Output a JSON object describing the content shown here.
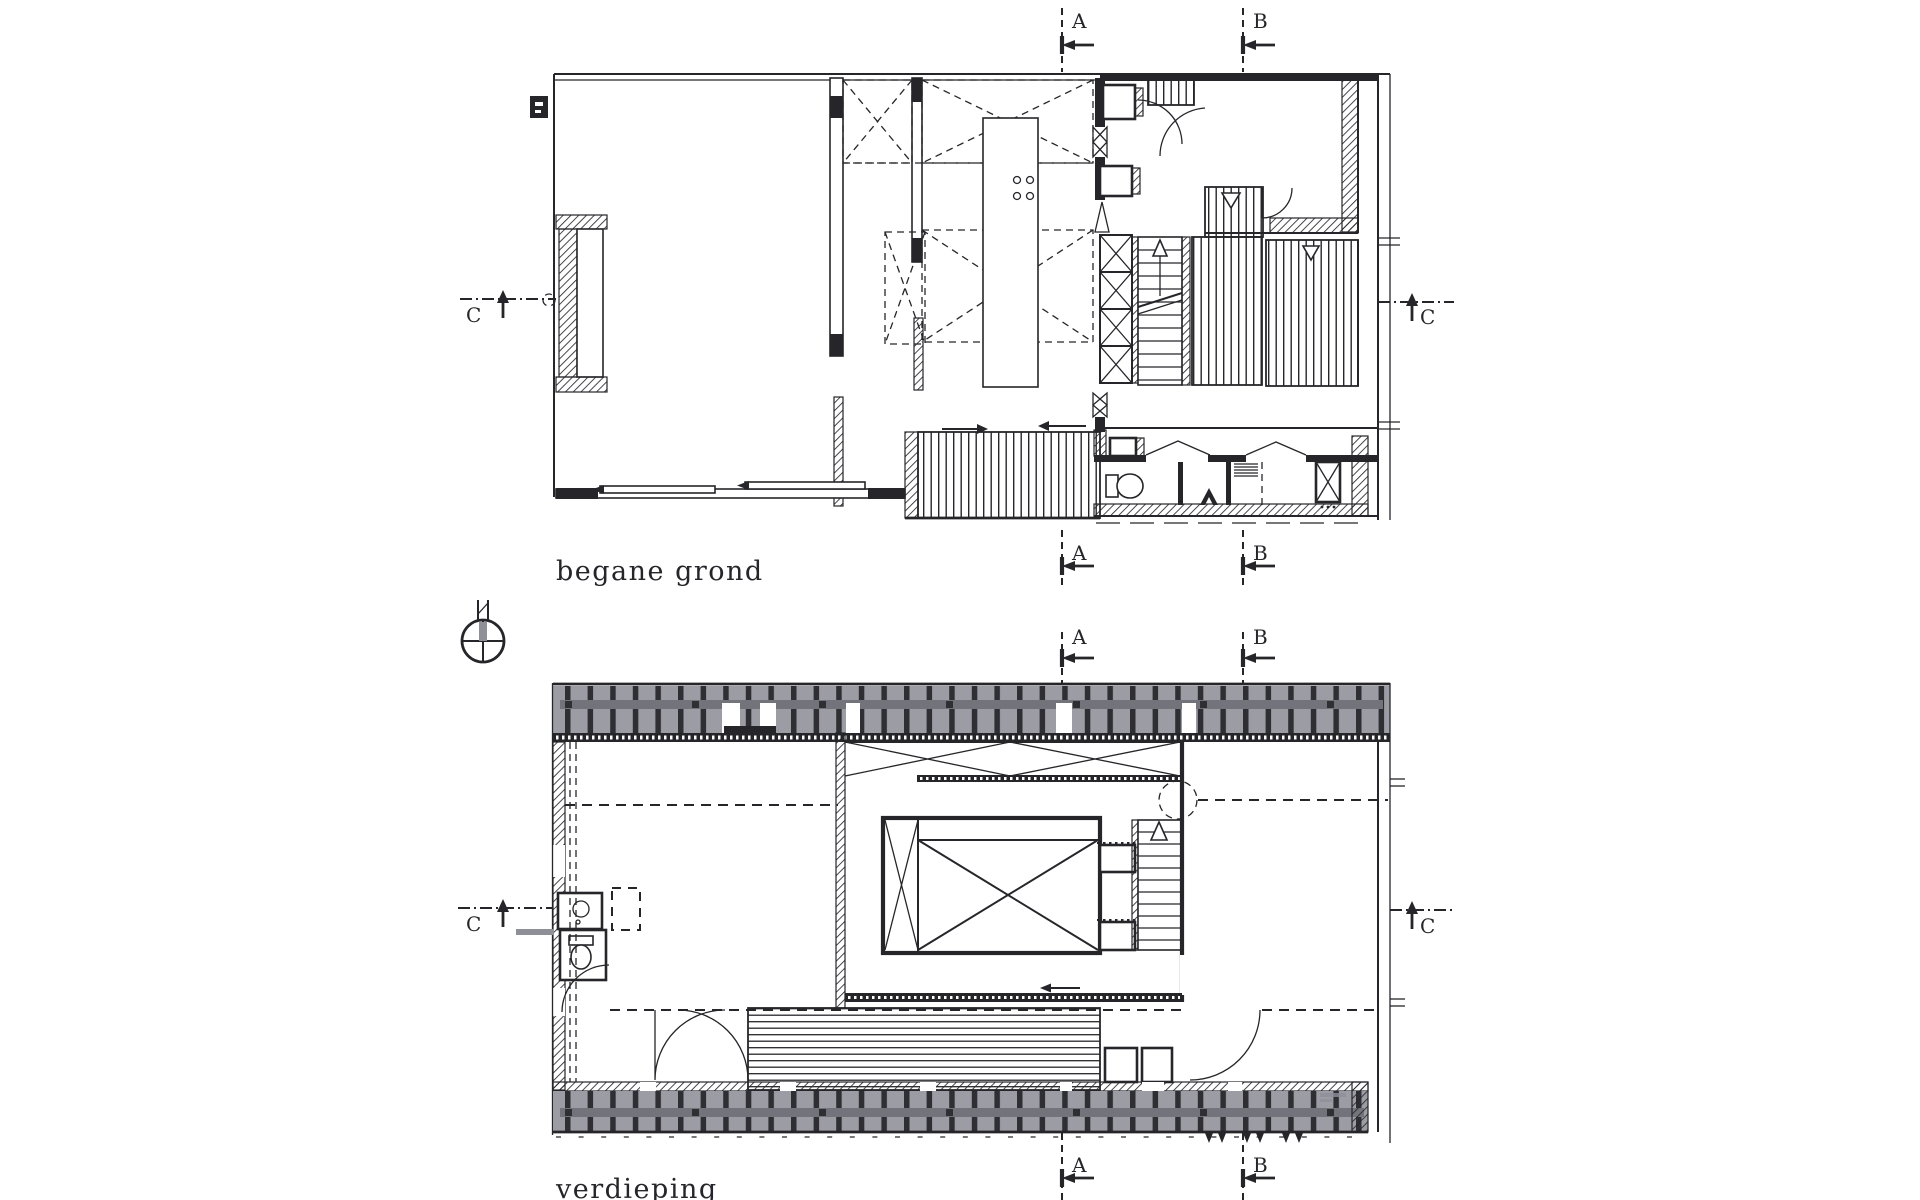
{
  "page": {
    "background": "#ffffff"
  },
  "drawing": {
    "plans": [
      {
        "id": "begane-grond",
        "label": "begane grond"
      },
      {
        "id": "verdieping",
        "label": "verdieping"
      }
    ],
    "section_markers": {
      "a": "A",
      "b": "B",
      "c": "C"
    },
    "colors": {
      "ink": "#26262a",
      "paper": "#ffffff",
      "louver": "#9c9ca5",
      "post": "#2e2e33",
      "rail": "#73737c",
      "gray": "#8f8f98"
    }
  }
}
